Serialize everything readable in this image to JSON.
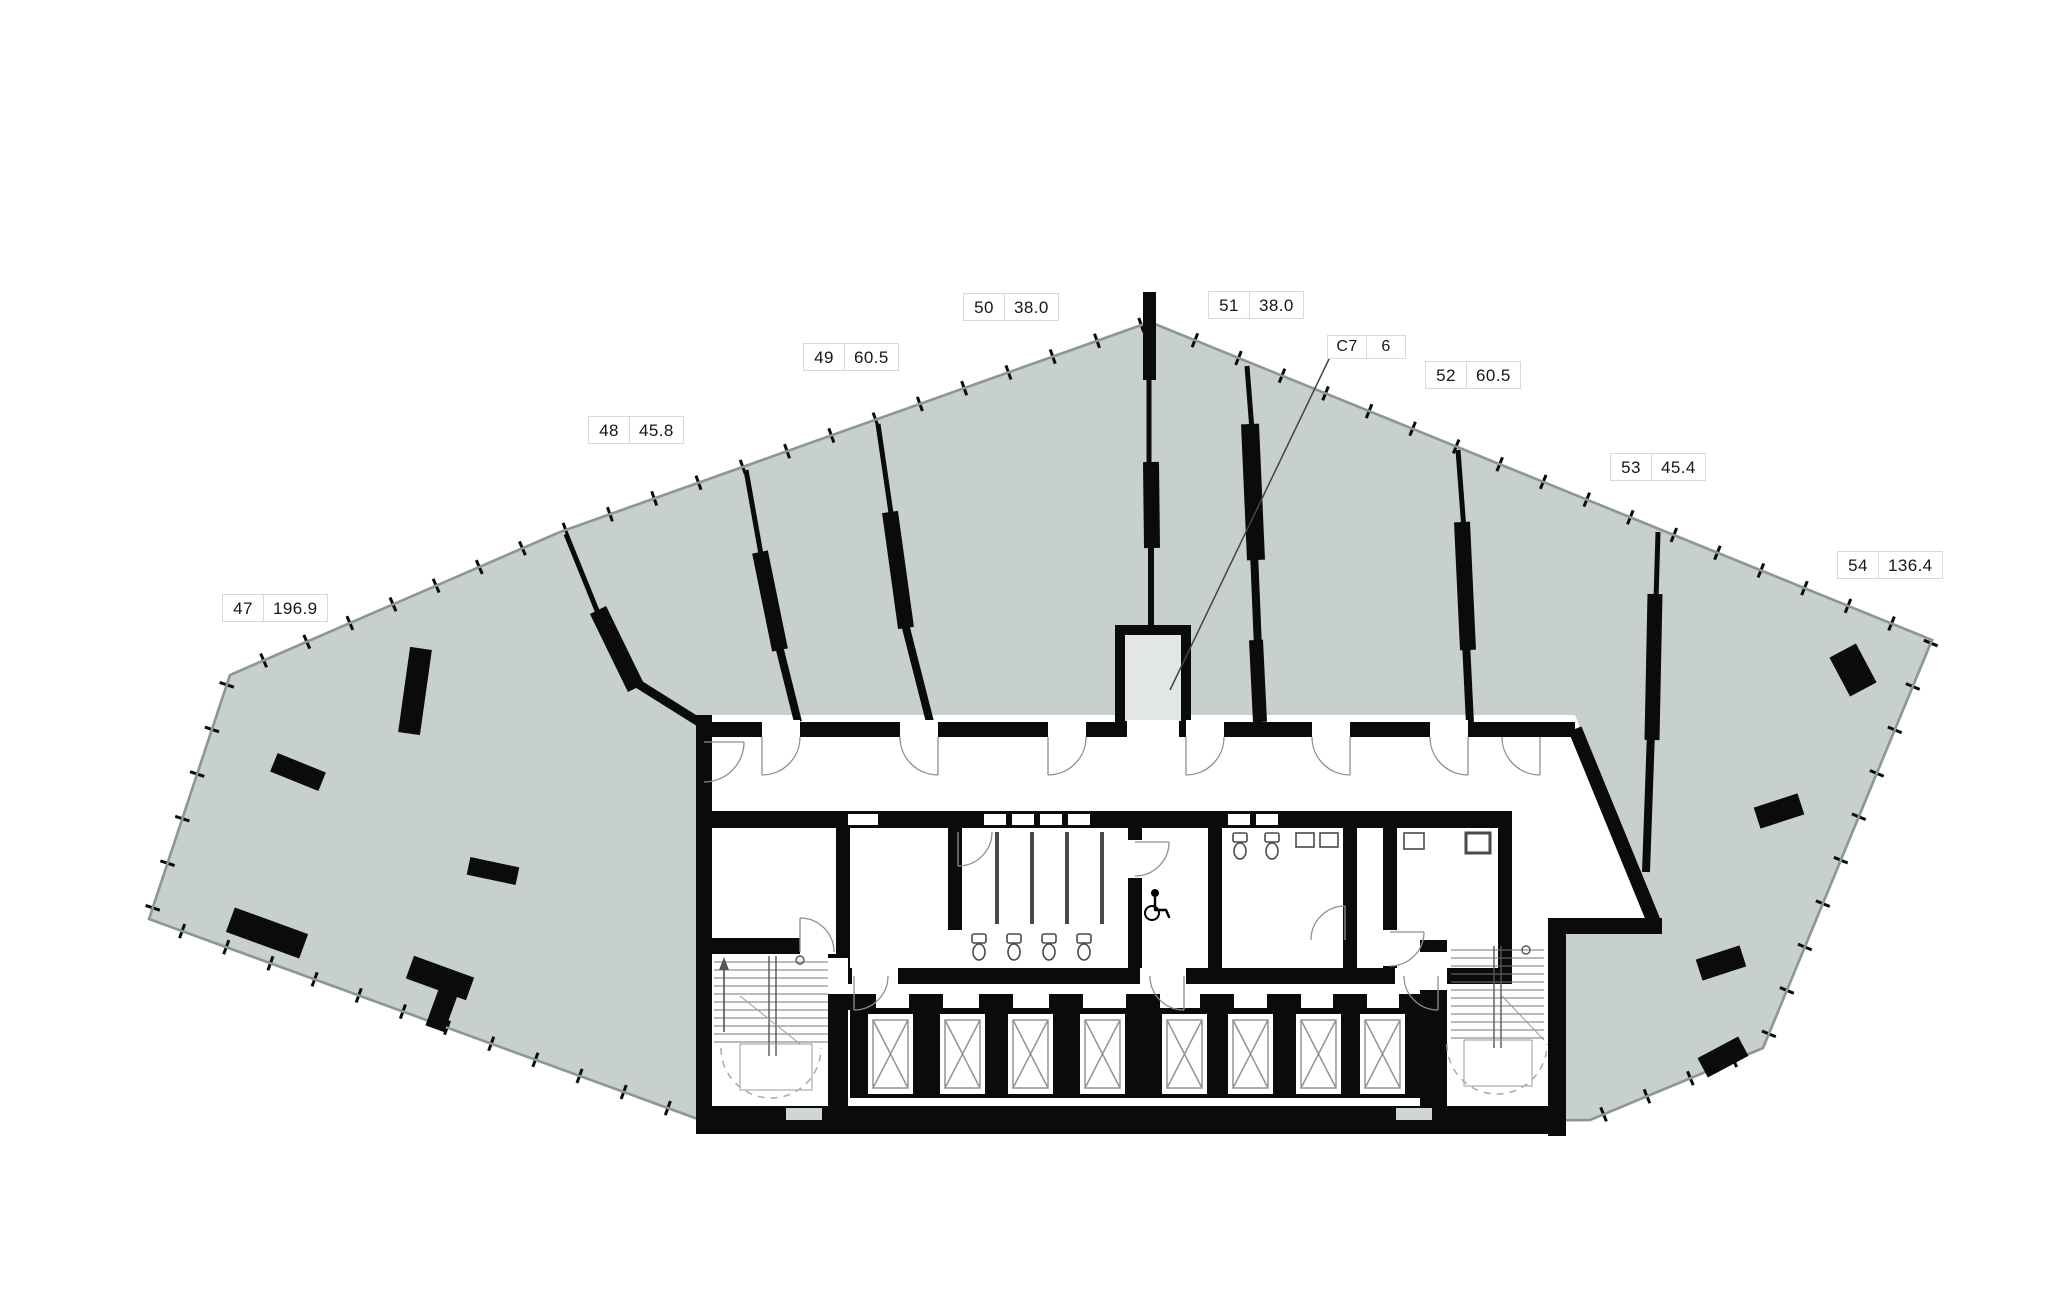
{
  "plan": {
    "floor_units": "commercial floor plan with numbered units and areas",
    "units": [
      {
        "id": "47",
        "area": "196.9"
      },
      {
        "id": "48",
        "area": "45.8"
      },
      {
        "id": "49",
        "area": "60.5"
      },
      {
        "id": "50",
        "area": "38.0"
      },
      {
        "id": "51",
        "area": "38.0"
      },
      {
        "id": "52",
        "area": "60.5"
      },
      {
        "id": "53",
        "area": "45.4"
      },
      {
        "id": "54",
        "area": "136.4"
      }
    ],
    "core_unit": {
      "id": "C7",
      "area": "6"
    },
    "icons": {
      "wheelchair": "wheelchair-icon",
      "stairs": "stairs-icon",
      "elevator": "elevator-shaft-x-icon"
    },
    "colors": {
      "unit_fill": "#c7d0cd",
      "outline": "#8d9794",
      "wall": "#0b0b0b",
      "door_arc": "#8f8f8f",
      "fixture": "#4a4a4a",
      "stair_line": "#777777",
      "dash": "#a9b2af",
      "shaft_fill": "#e2e7e4",
      "exit_slot": "#cfd6d3",
      "label_border": "#d9d9d9",
      "label_text": "#161616"
    }
  }
}
